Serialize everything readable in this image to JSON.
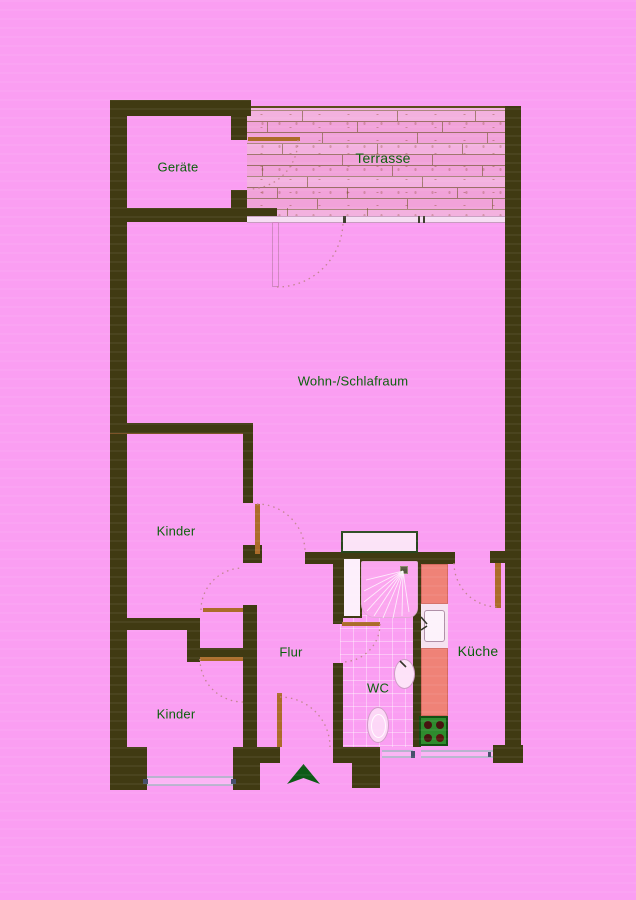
{
  "rooms": {
    "geraete": {
      "label": "Geräte"
    },
    "terrasse": {
      "label": "Terrasse"
    },
    "wohnschlafraum": {
      "label": "Wohn-/Schlafraum"
    },
    "kinder1": {
      "label": "Kinder"
    },
    "kinder2": {
      "label": "Kinder"
    },
    "flur": {
      "label": "Flur"
    },
    "wc": {
      "label": "WC"
    },
    "kueche": {
      "label": "Küche"
    }
  },
  "icons": {
    "entrance_arrow": "entrance-direction-arrow"
  },
  "colors": {
    "background": "#fa9ef2",
    "wall": "#403a12",
    "door_leaf": "#ab6c29",
    "label_text": "#0a5f0a",
    "arrow_green": "#0d5a16",
    "kitchen_counter": "#ef8277",
    "stove_green": "#2e8b2e",
    "terrace_plank": "#f1a2d9"
  }
}
